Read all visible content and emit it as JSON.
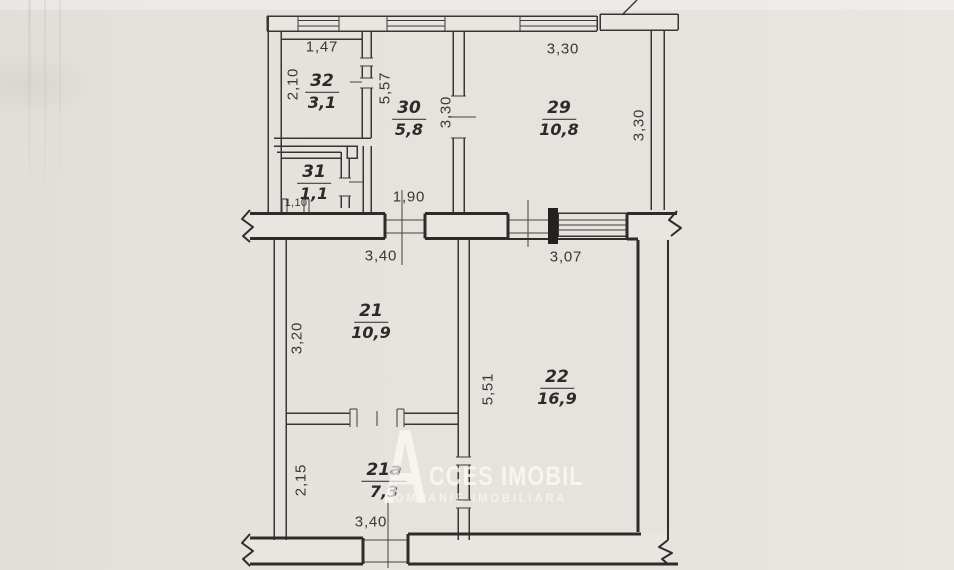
{
  "colors": {
    "background": "#e5e2dd",
    "line": "#383633",
    "thick_wall": "#2e2c29",
    "wall_fill": "#e9e6e1",
    "solid_pier_fill": "#242220",
    "watermark": "rgba(253,251,247,0.72)"
  },
  "rooms": [
    {
      "number": "32",
      "area": "3,1"
    },
    {
      "number": "30",
      "area": "5,8"
    },
    {
      "number": "29",
      "area": "10,8"
    },
    {
      "number": "31",
      "area": "1,1"
    },
    {
      "number": "21",
      "area": "10,9"
    },
    {
      "number": "22",
      "area": "16,9"
    },
    {
      "number": "21a",
      "area": "7,3"
    }
  ],
  "dimensions": [
    {
      "text": "1,47",
      "of": "room-32-width"
    },
    {
      "text": "2,10",
      "of": "room-32-height"
    },
    {
      "text": "5,57",
      "of": "room-30-height"
    },
    {
      "text": "3,30",
      "of": "room-29-width"
    },
    {
      "text": "3,30",
      "of": "wall-30-29-height"
    },
    {
      "text": "3,30",
      "of": "room-29-height"
    },
    {
      "text": "1,90",
      "of": "middle-wall-opening"
    },
    {
      "text": "1,10",
      "of": "room-31-opening"
    },
    {
      "text": "3,40",
      "of": "room-21-width"
    },
    {
      "text": "3,07",
      "of": "room-22-width"
    },
    {
      "text": "3,20",
      "of": "room-21-height"
    },
    {
      "text": "5,51",
      "of": "room-22-height"
    },
    {
      "text": "2,15",
      "of": "room-21a-height"
    },
    {
      "text": "3,40",
      "of": "room-21a-width"
    }
  ],
  "watermark": {
    "letter": "A",
    "rest": "CCES IMOBIL",
    "subtitle": "COMPANIE IMOBILIARA"
  }
}
